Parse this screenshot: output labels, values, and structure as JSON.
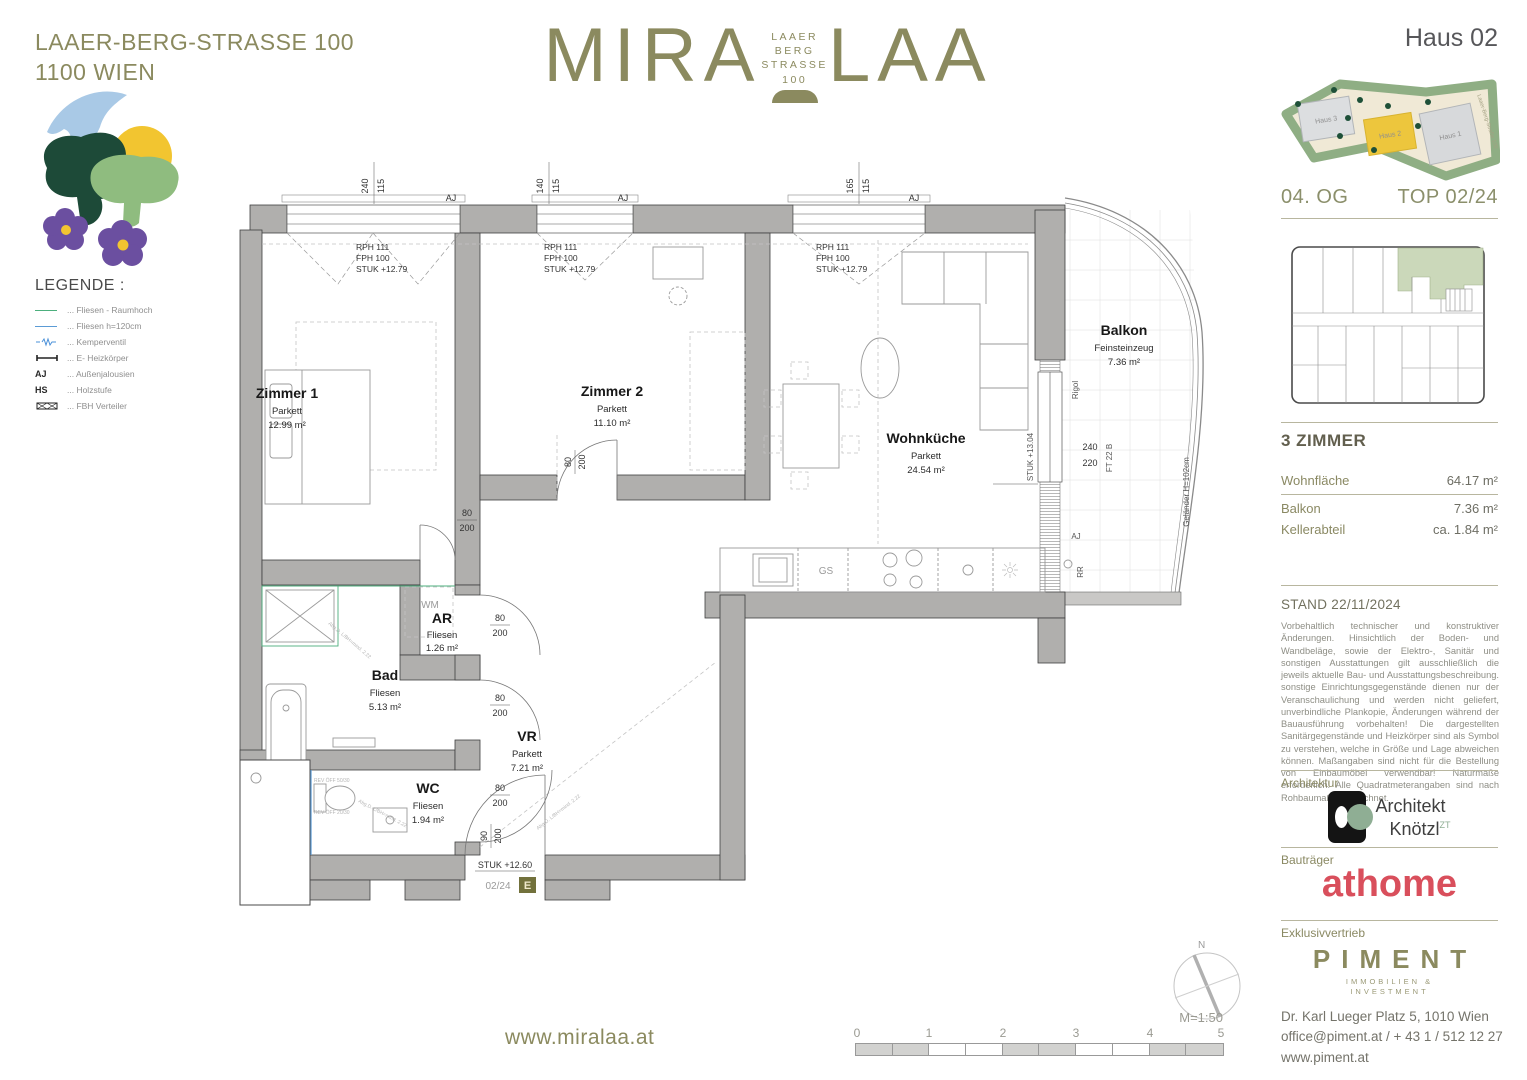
{
  "header": {
    "address_line1": "LAAER-BERG-STRASSE 100",
    "address_line2": "1100 WIEN",
    "website": "www.miralaa.at"
  },
  "logo": {
    "left": "MIRA",
    "right": "LAA",
    "sub1": "LAAER",
    "sub2": "BERG",
    "sub3": "STRASSE",
    "sub4": "100"
  },
  "legend": {
    "title": "LEGENDE :",
    "items": [
      {
        "label": "... Fliesen - Raumhoch"
      },
      {
        "label": "... Fliesen h=120cm"
      },
      {
        "label": "... Kemperventil"
      },
      {
        "label": "... E- Heizkörper"
      },
      {
        "symbol": "AJ",
        "label": "... Außenjalousien"
      },
      {
        "symbol": "HS",
        "label": "... Holzstufe"
      },
      {
        "label": "... FBH Verteiler"
      }
    ]
  },
  "sidebar": {
    "haus_title": "Haus 02",
    "siteplan": {
      "haus1": "Haus 1",
      "haus2": "Haus 2",
      "haus3": "Haus 3",
      "street": "Laaer-Berg-Straße 100"
    },
    "floor": "04. OG",
    "top": "TOP 02/24",
    "rooms_title": "3 ZIMMER",
    "areas": [
      {
        "label": "Wohnfläche",
        "value": "64.17 m²"
      },
      {
        "label": "Balkon",
        "value": "7.36 m²"
      },
      {
        "label": "Kellerabteil",
        "value": "ca. 1.84 m²"
      }
    ],
    "stand": "STAND 22/11/2024",
    "disclaimer": "Vorbehaltlich technischer und konstruktiver Änderungen. Hinsichtlich der Boden- und Wandbeläge, sowie der Elektro-, Sanitär und sonstigen Ausstattungen gilt ausschließlich die jeweils aktuelle Bau- und Ausstattungsbeschreibung. sonstige Einrichtungsgegenstände dienen nur der Veranschaulichung und werden nicht geliefert, unverbindliche Plankopie, Änderungen während der Bauausführung vorbehalten! Die dargestellten Sanitärgegenstände und Heizkörper sind als Symbol zu verstehen, welche in Größe und Lage abweichen können. Maßangaben sind nicht für die Bestellung von Einbaumöbel verwendbar! Naturmaße erforderlich! Alle Quadratmeterangaben sind nach Rohbaumaßen berechnet.",
    "architektur_label": "Architektur",
    "architect_line1": "Architekt",
    "architect_line2": "Knötzl",
    "architect_sup": "ZT",
    "bautraeger_label": "Bauträger",
    "bautraeger_name": "athome",
    "exklusiv_label": "Exklusivvertrieb",
    "piment_name": "PIMENT",
    "piment_sub1": "IMMOBILIEN &",
    "piment_sub2": "INVESTMENT",
    "contact_line1": "Dr. Karl Lueger Platz 5, 1010 Wien",
    "contact_line2": "office@piment.at / + 43 1 / 512 12 27",
    "contact_line3": "www.piment.at"
  },
  "plan": {
    "rooms": [
      {
        "name": "Zimmer 1",
        "floor": "Parkett",
        "area": "12.99 m²"
      },
      {
        "name": "Zimmer 2",
        "floor": "Parkett",
        "area": "11.10 m²"
      },
      {
        "name": "Wohnküche",
        "floor": "Parkett",
        "area": "24.54 m²"
      },
      {
        "name": "Balkon",
        "floor": "Feinsteinzeug",
        "area": "7.36 m²"
      },
      {
        "name": "Bad",
        "floor": "Fliesen",
        "area": "5.13 m²"
      },
      {
        "name": "AR",
        "floor": "Fliesen",
        "area": "1.26 m²"
      },
      {
        "name": "WC",
        "floor": "Fliesen",
        "area": "1.94 m²"
      },
      {
        "name": "VR",
        "floor": "Parkett",
        "area": "7.21 m²"
      }
    ],
    "windows": [
      {
        "w": "240",
        "h": "115"
      },
      {
        "w": "140",
        "h": "115"
      },
      {
        "w": "165",
        "h": "115"
      }
    ],
    "window_note": {
      "l1": "RPH 111",
      "l2": "FPH 100",
      "l3": "STUK +12.79"
    },
    "door_dim": {
      "w": "80",
      "h": "200"
    },
    "entry_dim": {
      "w": "90",
      "h": "200"
    },
    "codes": {
      "aj": "AJ",
      "rr": "RR",
      "wm": "WM",
      "gs": "GS",
      "rigol": "Rigol",
      "stuk_balkon": "STUK +13.04",
      "balkon_door_w": "240",
      "balkon_door_h": "220",
      "ft": "FT 22 B",
      "gelaender": "Geländer H=102cm",
      "stuk_entry": "STUK +12.60",
      "unit": "02/24",
      "unit_e": "E",
      "rev1": "REV ÖFF 50/30",
      "rev2": "REV ÖFF 20/30",
      "abg": "Abg.D. L/BH=mind. 2.22"
    }
  },
  "footer": {
    "north": "N",
    "scale": "M=1:50",
    "ticks": [
      "0",
      "1",
      "2",
      "3",
      "4",
      "5"
    ]
  }
}
